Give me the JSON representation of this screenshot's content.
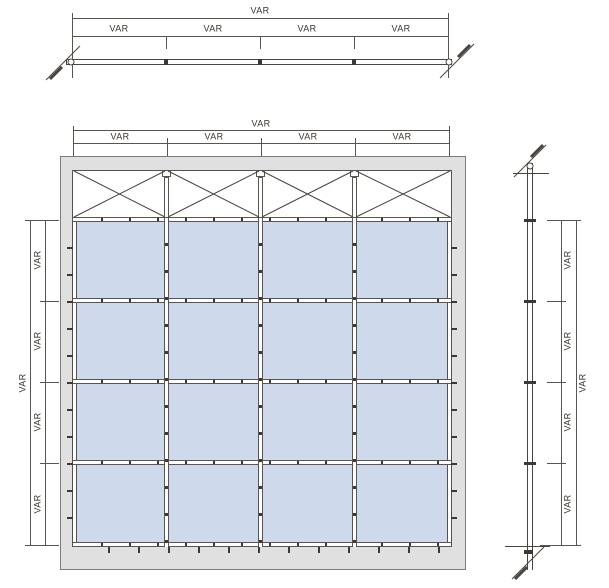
{
  "dims": {
    "top_section": {
      "overall": "VAR",
      "segments": [
        "VAR",
        "VAR",
        "VAR",
        "VAR"
      ]
    },
    "elevation_top": {
      "overall": "VAR",
      "segments": [
        "VAR",
        "VAR",
        "VAR",
        "VAR"
      ]
    },
    "elevation_left": {
      "overall": "VAR",
      "segments": [
        "VAR",
        "VAR",
        "VAR",
        "VAR"
      ]
    },
    "side_section": {
      "overall": "VAR",
      "segments": [
        "VAR",
        "VAR",
        "VAR",
        "VAR"
      ]
    }
  },
  "grid": {
    "panel_columns": 4,
    "panel_rows": 4,
    "braced_top_bays": 4
  },
  "colors": {
    "glass_panel": "#cfd9ec",
    "frame_fill": "#e0e0e0",
    "drawing_line": "#4a443e",
    "dimension_line": "#5a544e"
  }
}
